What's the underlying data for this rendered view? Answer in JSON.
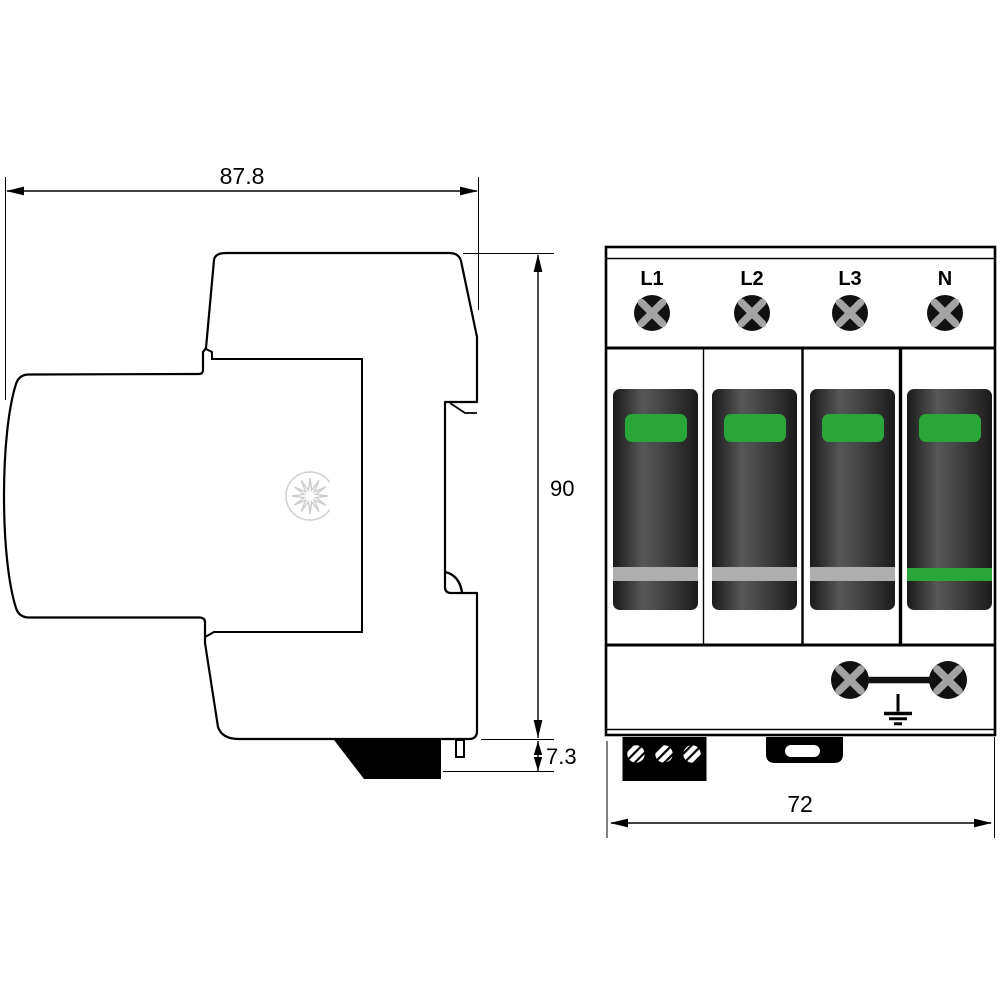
{
  "dimensions": {
    "side_width": "87.8",
    "side_height": "90",
    "foot_height": "7.3",
    "front_width": "72"
  },
  "terminals": [
    "L1",
    "L2",
    "L3",
    "N"
  ],
  "colors": {
    "indicator_green": "#2aa53a",
    "stripe_gray": "#aeaeae",
    "module_dark": "#1a1a1a",
    "module_mid": "#565656",
    "screw_black": "#111111",
    "screw_cross": "#a3a3a3",
    "logo_gray": "#cfcfcf",
    "line_black": "#000000"
  },
  "modules": [
    {
      "terminal": "L1",
      "indicator": "green",
      "bottom_stripe": "gray"
    },
    {
      "terminal": "L2",
      "indicator": "green",
      "bottom_stripe": "gray"
    },
    {
      "terminal": "L3",
      "indicator": "green",
      "bottom_stripe": "gray"
    },
    {
      "terminal": "N",
      "indicator": "green",
      "bottom_stripe": "green"
    }
  ]
}
